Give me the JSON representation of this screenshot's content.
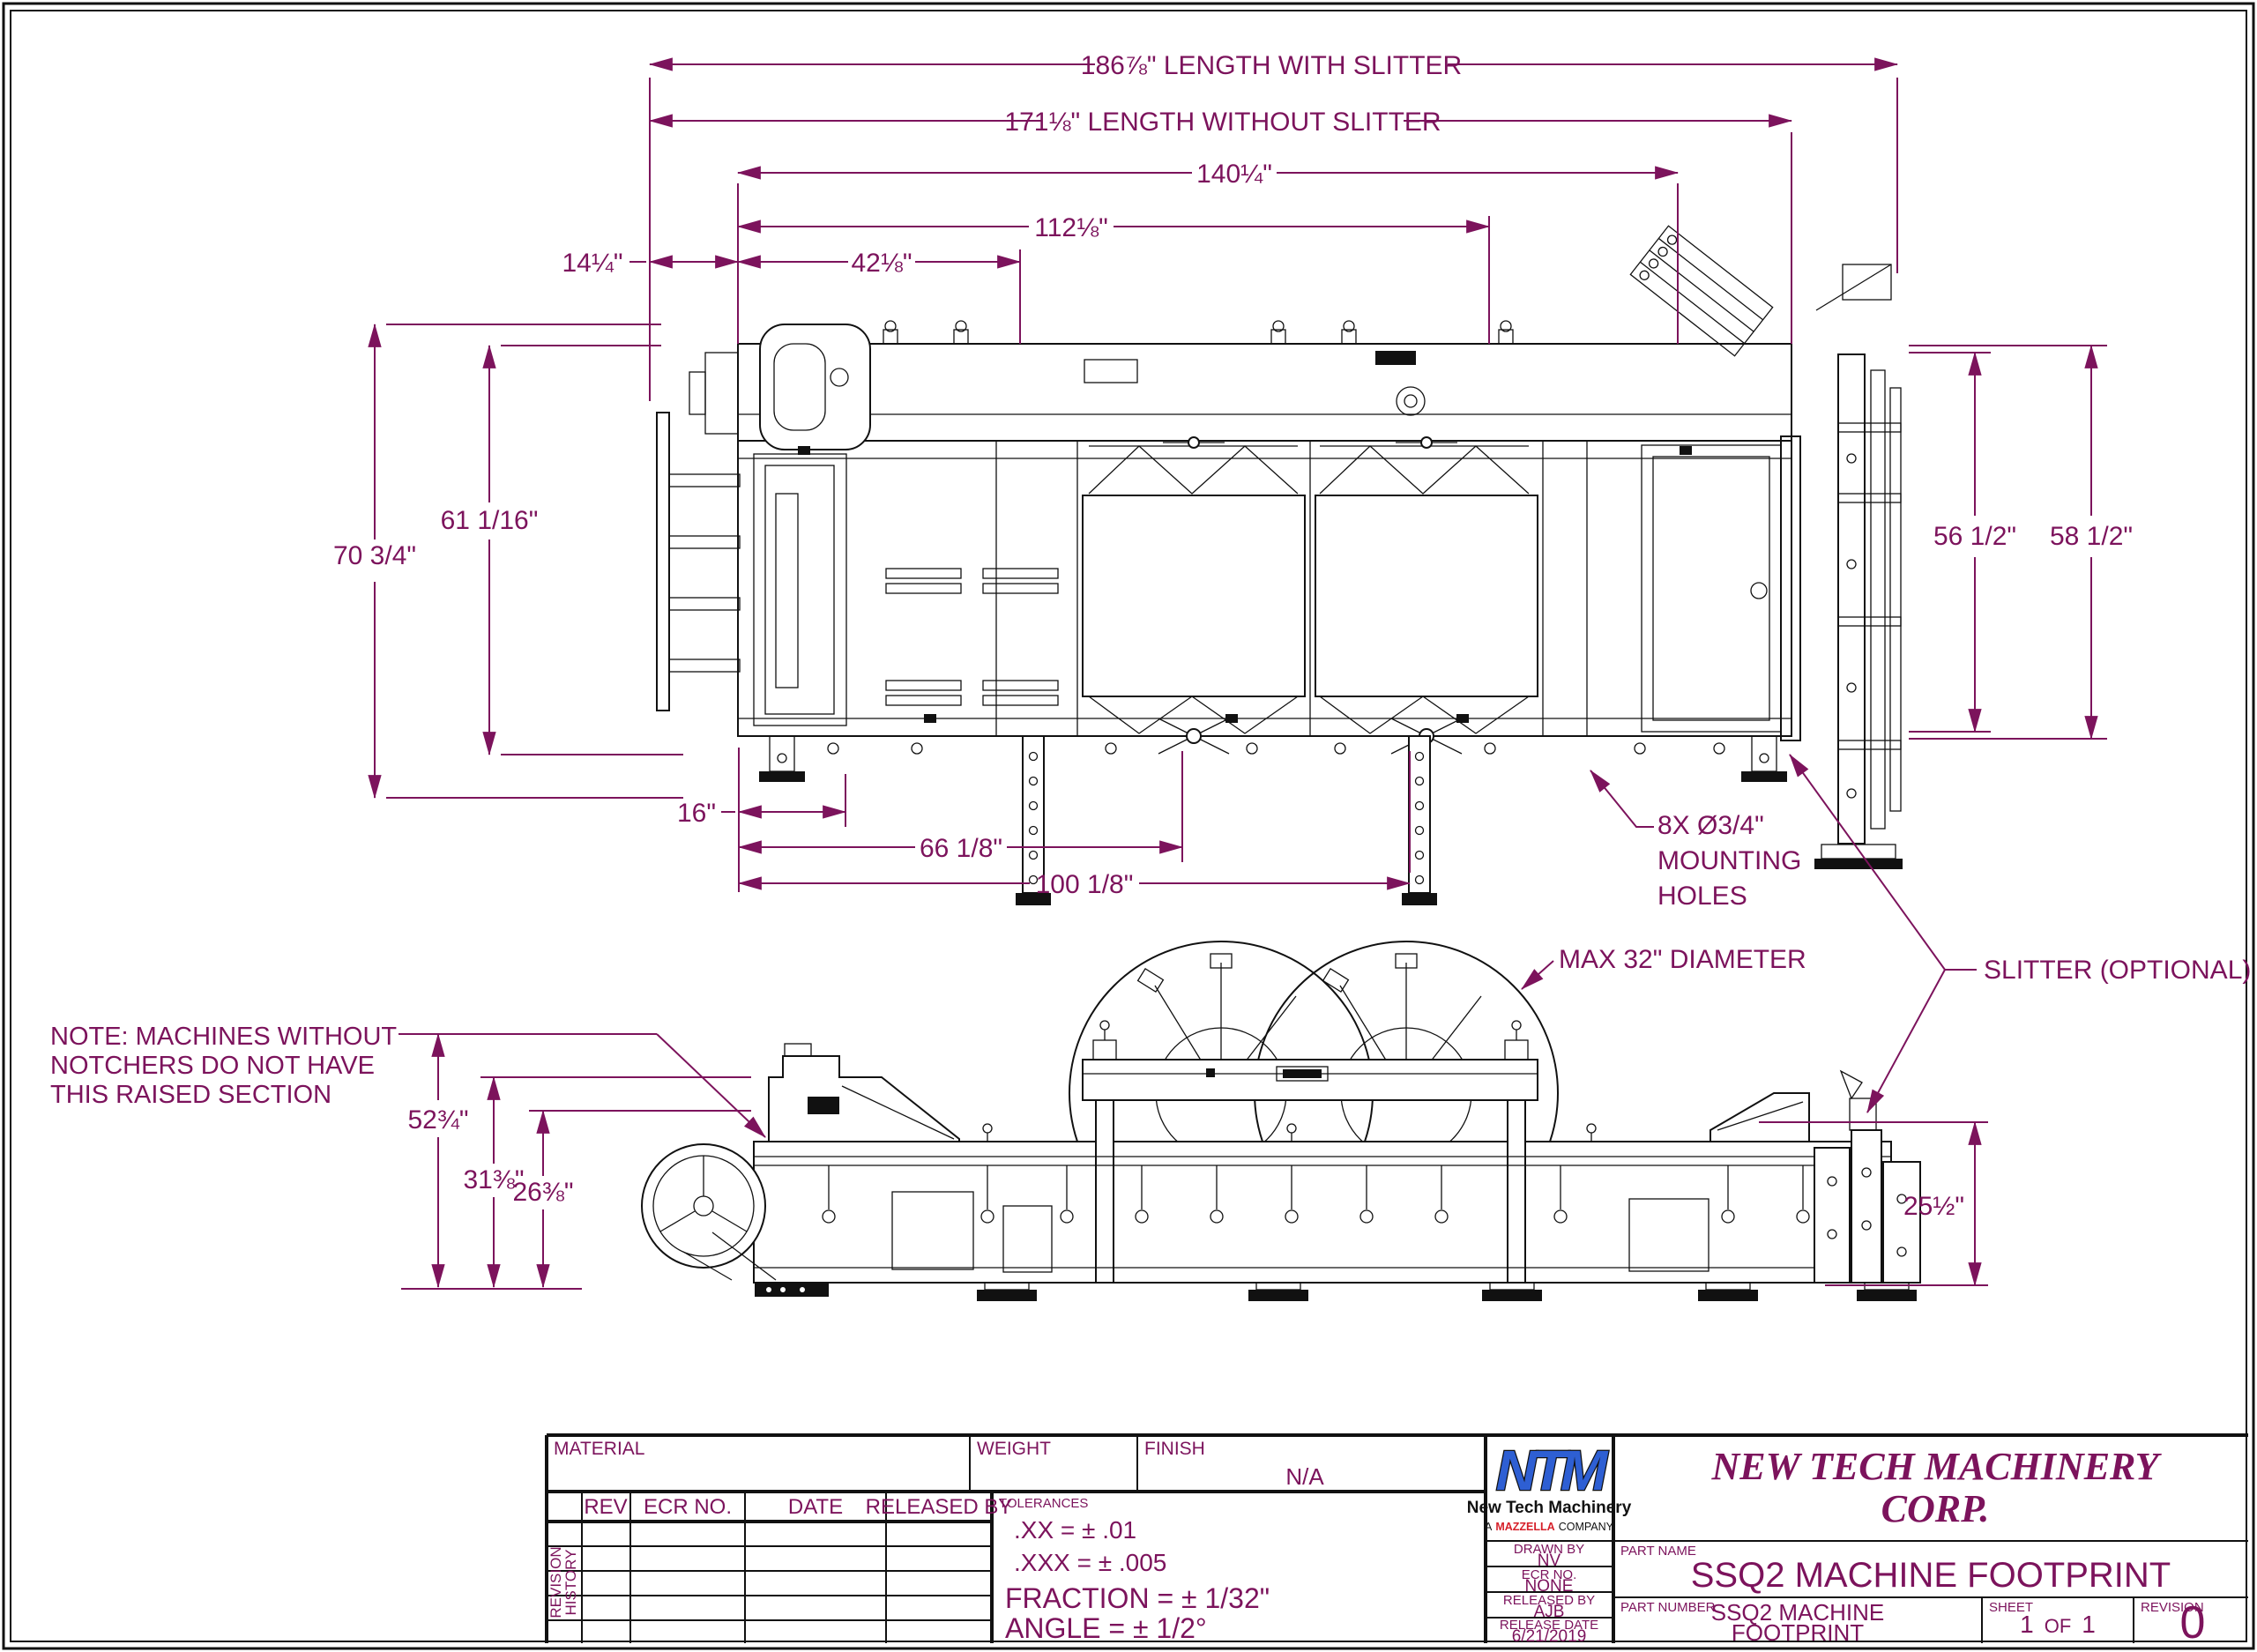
{
  "colors": {
    "dimension": "#7C135C",
    "line": "#111111",
    "logo_blue": "#2E5FD3",
    "logo_red": "#D6202A"
  },
  "dims": {
    "d186": "186⅞\" LENGTH WITH SLITTER",
    "d171": "171⅛\" LENGTH WITHOUT SLITTER",
    "d140": "140¼\"",
    "d112": "112⅛\"",
    "d14": "14¼\"",
    "d42": "42⅛\"",
    "d70": "70 3/4\"",
    "d61": "61 1/16\"",
    "d56": "56 1/2\"",
    "d58": "58 1/2\"",
    "d16": "16\"",
    "d66": "66 1/8\"",
    "d100": "100 1/8\"",
    "d52": "52¾\"",
    "d31": "31⅜\"",
    "d26": "26⅜\"",
    "d25": "25½\""
  },
  "labels": {
    "mounting": [
      "8X Ø3/4\"",
      "MOUNTING",
      "HOLES"
    ],
    "max32": "MAX 32\" DIAMETER",
    "slitter": "SLITTER (OPTIONAL)",
    "note": [
      "NOTE:  MACHINES WITHOUT",
      "NOTCHERS DO NOT HAVE",
      "THIS RAISED SECTION"
    ]
  },
  "title_block": {
    "material_label": "MATERIAL",
    "weight_label": "WEIGHT",
    "finish_label": "FINISH",
    "finish_value": "N/A",
    "revision_history": [
      "REVISION",
      "HISTORY"
    ],
    "rev_headers": [
      "REV",
      "ECR NO.",
      "DATE",
      "RELEASED BY"
    ],
    "tolerances_label": "TOLERANCES",
    "tolerances": [
      ".XX = ± .01",
      ".XXX = ± .005",
      "FRACTION = ± 1/32\"",
      "ANGLE = ± 1/2°"
    ],
    "logo": {
      "ntm": "NTM",
      "name": "New Tech Machinery",
      "company_a": "A",
      "company_brand": "MAZZELLA",
      "company_word": "COMPANY"
    },
    "company": [
      "NEW TECH MACHINERY",
      "CORP."
    ],
    "drawn_by_label": "DRAWN BY",
    "drawn_by": "NV",
    "ecr_label": "ECR NO.",
    "ecr": "NONE",
    "released_by_label": "RELEASED BY",
    "released_by": "AJB",
    "release_date_label": "RELEASE DATE",
    "release_date": "6/21/2019",
    "part_name_label": "PART NAME",
    "part_name": "SSQ2 MACHINE FOOTPRINT",
    "part_number_label": "PART NUMBER",
    "part_number": [
      "SSQ2 MACHINE",
      "FOOTPRINT"
    ],
    "sheet_label": "SHEET",
    "sheet": [
      "1",
      "OF",
      "1"
    ],
    "revision_label": "REVISION",
    "revision": "0"
  }
}
